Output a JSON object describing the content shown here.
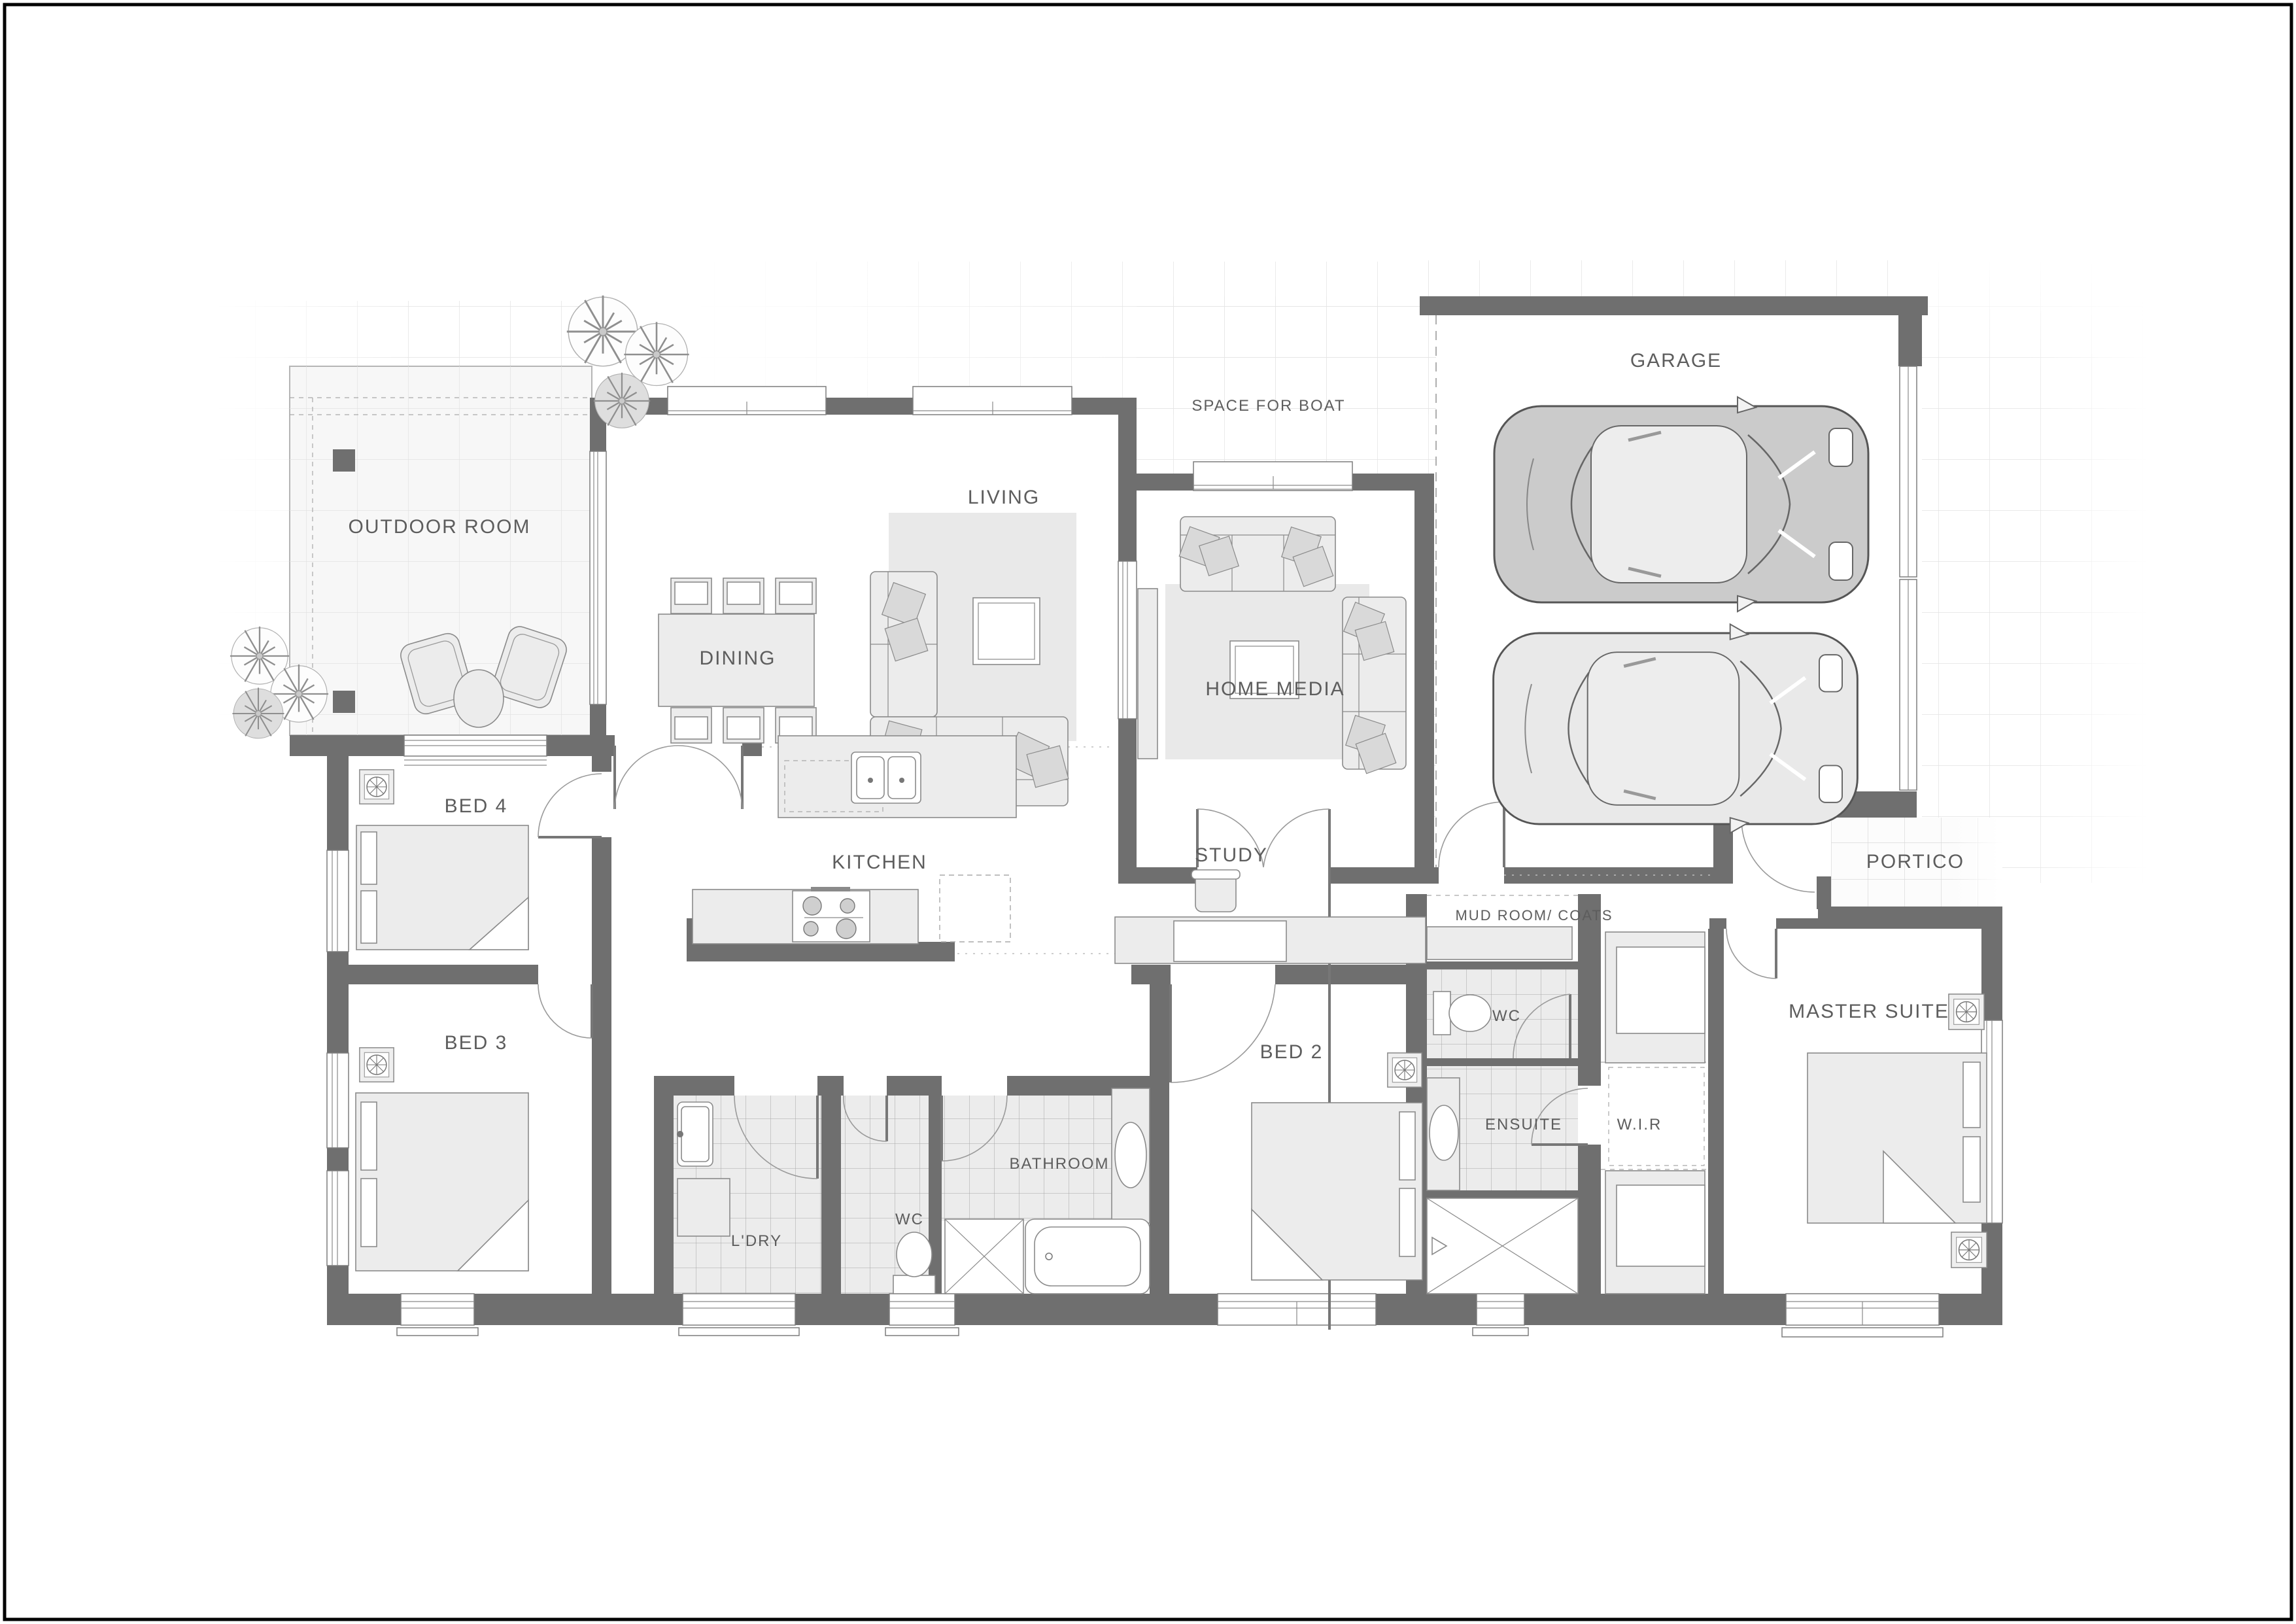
{
  "document": {
    "kind": "architectural-floor-plan",
    "view": "top-down"
  },
  "colors": {
    "wall": "#6f6f6f",
    "label_text": "#5d5d5d",
    "landscape_tile_line": "#e2e2e2",
    "wet_room_tile": "#ececec",
    "furniture_fill": "#ececec",
    "car_dark": "#cbcbcb",
    "car_light": "#e9e9e9",
    "page_border": "#000000"
  },
  "icons": {
    "tree": "spiky-canopy-circle",
    "ceiling_fan": "square-with-spoked-circle",
    "car": "top-view-car",
    "double_sink": "two-basin-kitchen-sink",
    "stove": "four-burner-cooktop",
    "toilet": "tank-and-bowl",
    "shower": "crossed-square",
    "bathtub": "rounded-tub"
  },
  "rooms": [
    {
      "id": "outdoor-room",
      "label": "OUTDOOR ROOM"
    },
    {
      "id": "dining",
      "label": "DINING"
    },
    {
      "id": "living",
      "label": "LIVING"
    },
    {
      "id": "home-media",
      "label": "HOME MEDIA"
    },
    {
      "id": "space-for-boat",
      "label": "SPACE FOR BOAT"
    },
    {
      "id": "garage",
      "label": "GARAGE"
    },
    {
      "id": "portico",
      "label": "PORTICO"
    },
    {
      "id": "master-suite",
      "label": "MASTER SUITE"
    },
    {
      "id": "bed-2",
      "label": "BED 2"
    },
    {
      "id": "bed-3",
      "label": "BED 3"
    },
    {
      "id": "bed-4",
      "label": "BED 4"
    },
    {
      "id": "kitchen",
      "label": "KITCHEN"
    },
    {
      "id": "study",
      "label": "STUDY"
    },
    {
      "id": "mud-room",
      "label": "MUD ROOM/ COATS"
    },
    {
      "id": "wc-hall",
      "label": "WC"
    },
    {
      "id": "wc-master",
      "label": "WC"
    },
    {
      "id": "ensuite",
      "label": "ENSUITE"
    },
    {
      "id": "wir",
      "label": "W.I.R"
    },
    {
      "id": "bathroom",
      "label": "BATHROOM"
    },
    {
      "id": "laundry",
      "label": "L'DRY"
    }
  ]
}
